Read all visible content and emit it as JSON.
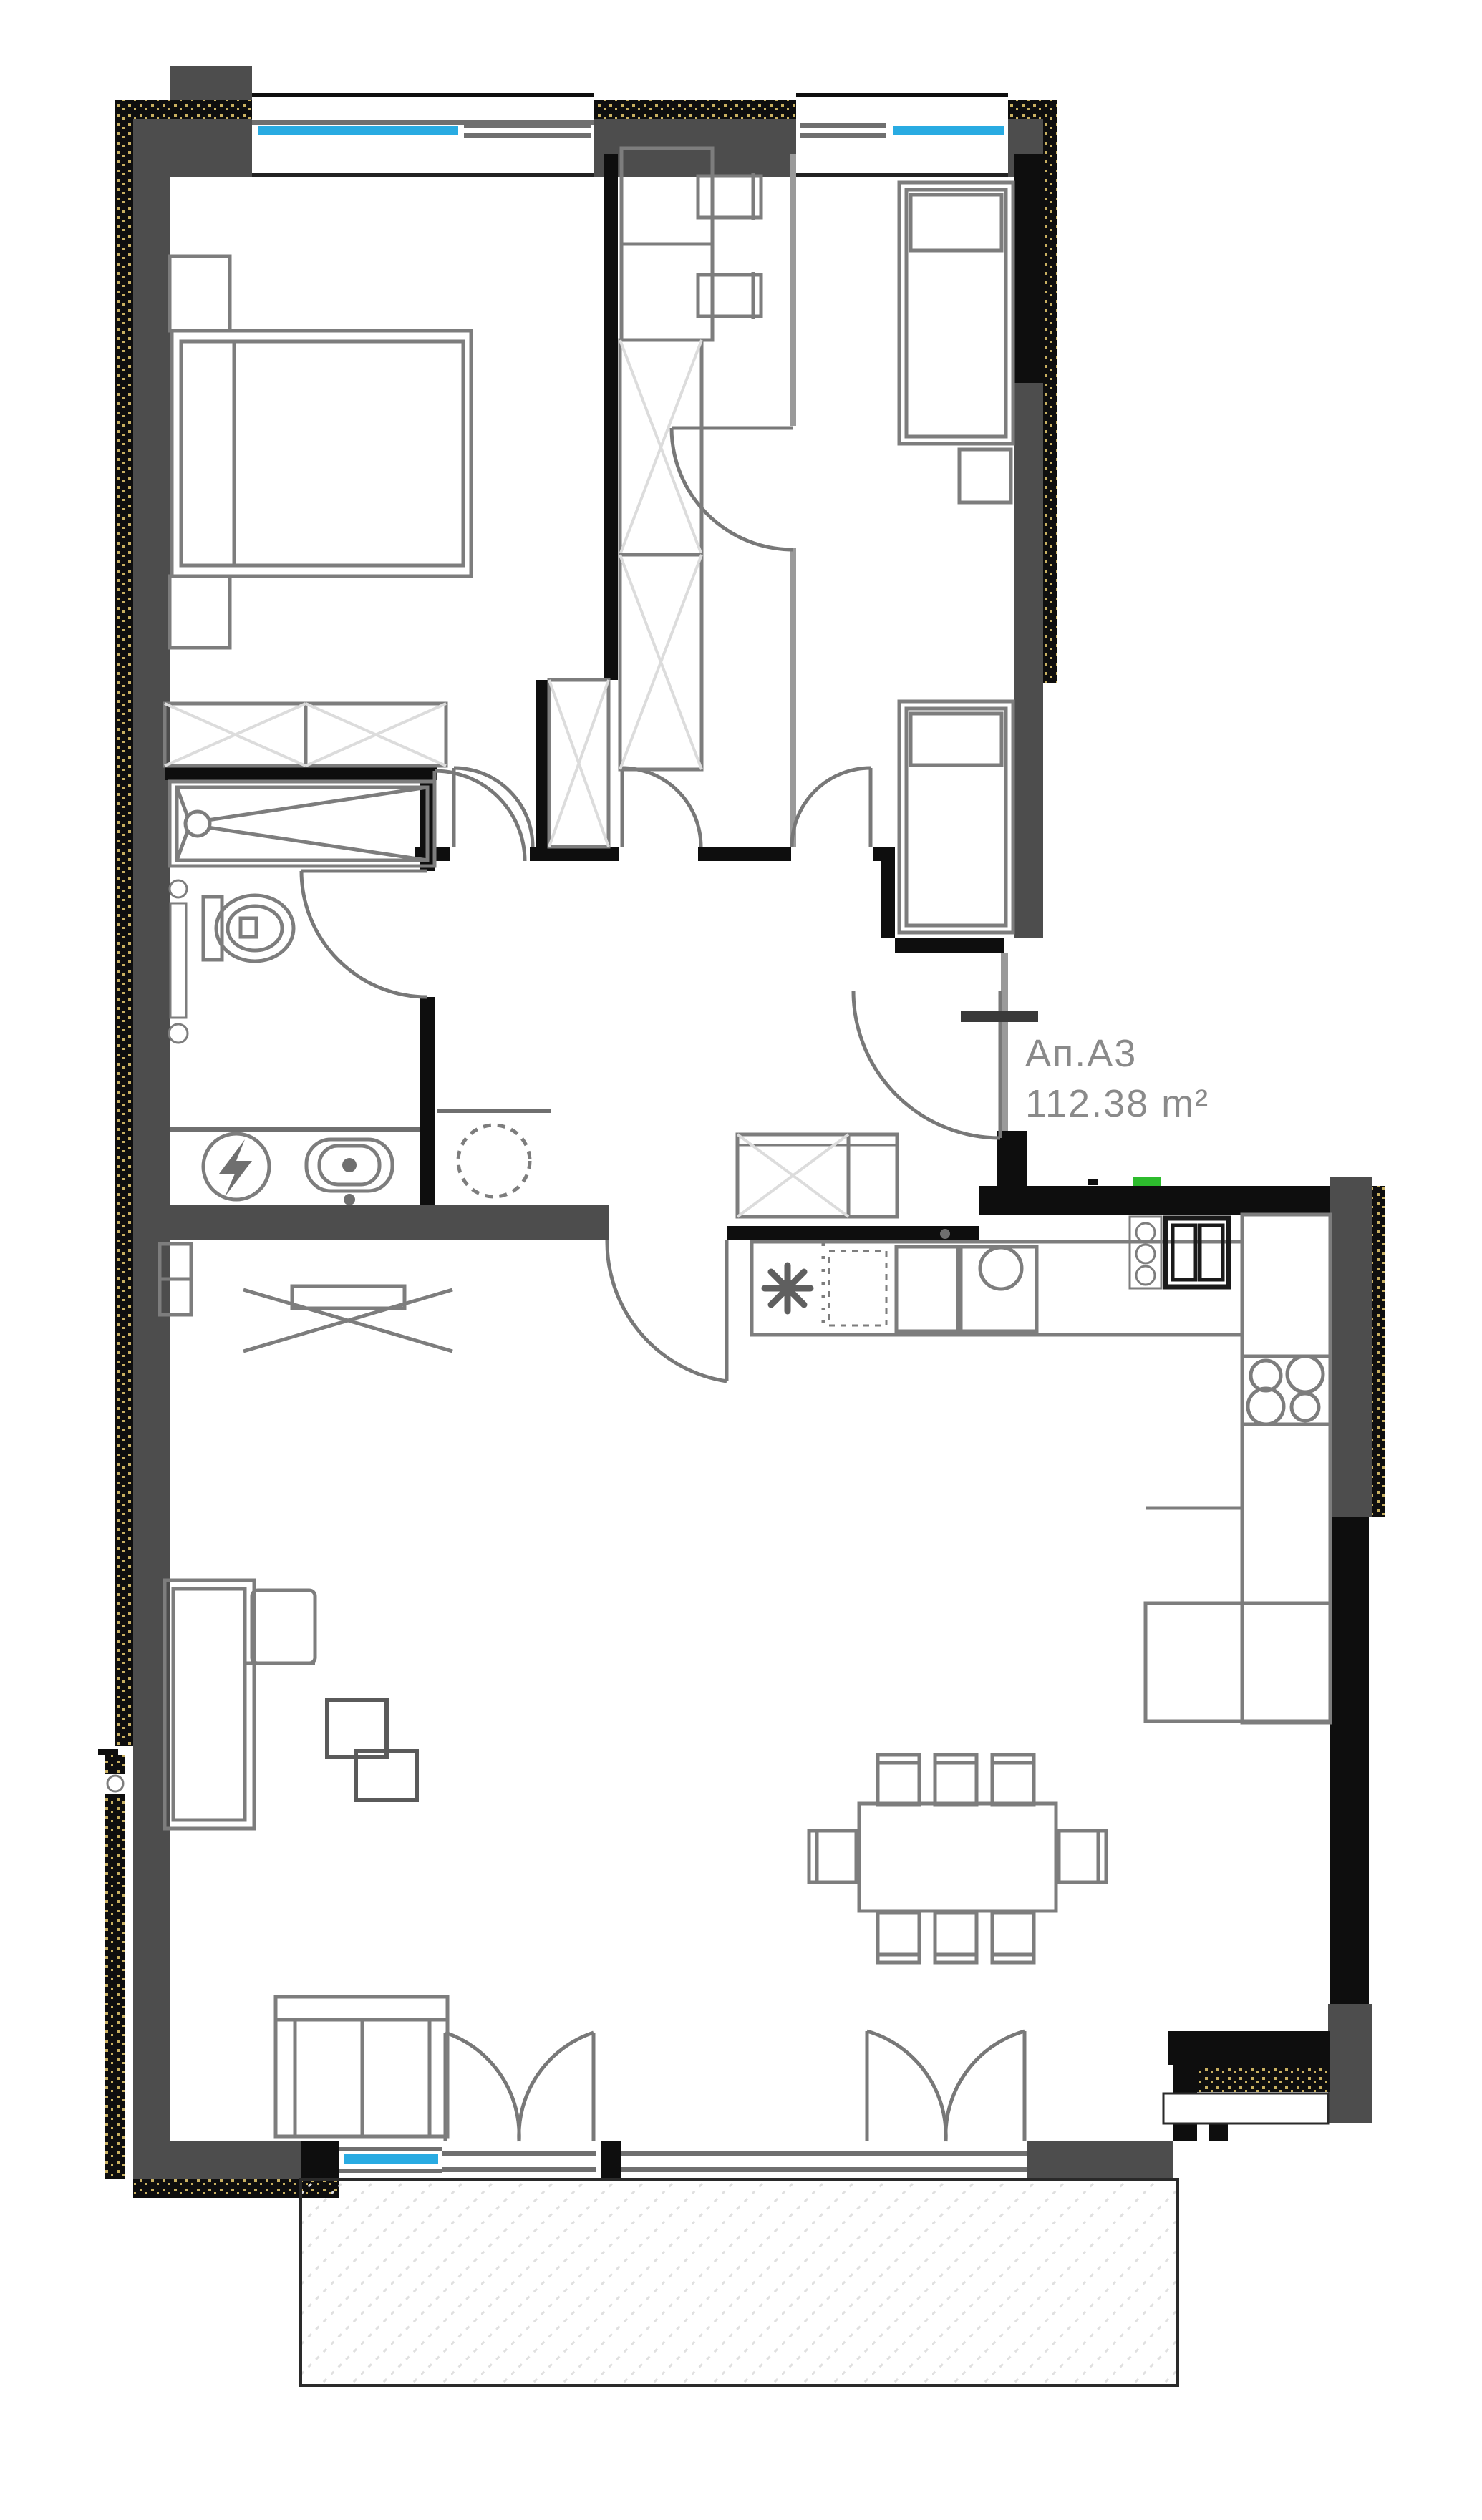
{
  "labels": {
    "unit": "Ап.А3",
    "area": "112.38 m²"
  },
  "colors": {
    "wall_dark": "#4d4d4d",
    "wall_black": "#0e0e0e",
    "window_blue": "#29abe2",
    "accent_green": "#2dbb2d",
    "insul_gold": "#c9b061",
    "furn": "#7d7d7d",
    "furn_dark": "#5a5a5a",
    "label": "#8a8a8a",
    "hatch_light": "#dcdcdc"
  },
  "icons": {
    "boiler": "lightning-bolt-in-circle",
    "fridge_spot": "snowflake-asterisk",
    "shower_drain": "circle-with-diagonals"
  }
}
